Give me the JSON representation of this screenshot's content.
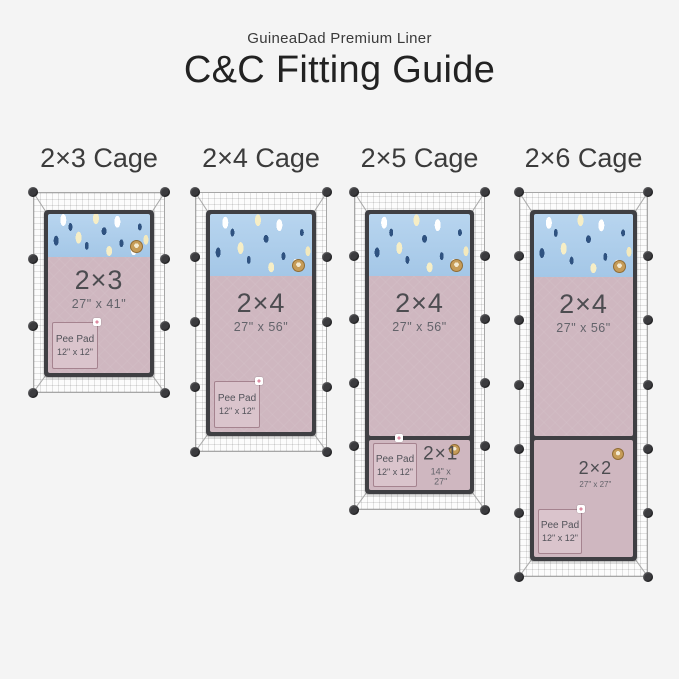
{
  "header": {
    "brand": "GuineaDad Premium Liner",
    "title": "C&C Fitting Guide"
  },
  "cages": [
    {
      "title": "2×3 Cage",
      "main_liner": {
        "name": "2×3",
        "dims": "27\" x 41\""
      },
      "pee_pad": {
        "name": "Pee Pad",
        "dims": "12\" x 12\""
      }
    },
    {
      "title": "2×4 Cage",
      "main_liner": {
        "name": "2×4",
        "dims": "27\" x 56\""
      },
      "pee_pad": {
        "name": "Pee Pad",
        "dims": "12\" x 12\""
      }
    },
    {
      "title": "2×5 Cage",
      "main_liner": {
        "name": "2×4",
        "dims": "27\" x 56\""
      },
      "sub_liner": {
        "name": "2×1",
        "dims": "14\" x 27\""
      },
      "pee_pad": {
        "name": "Pee Pad",
        "dims": "12\" x 12\""
      }
    },
    {
      "title": "2×6 Cage",
      "main_liner": {
        "name": "2×4",
        "dims": "27\" x 56\""
      },
      "sub_liner": {
        "name": "2×2",
        "dims": "27\" x 27\""
      },
      "pee_pad": {
        "name": "Pee Pad",
        "dims": "12\" x 12\""
      }
    }
  ],
  "icons": {
    "logo_badge": "guineadad-face-badge",
    "connector": "cage-connector-dot",
    "snap": "liner-snap-button"
  },
  "colors": {
    "background": "#f4f4f4",
    "liner_pink": "#cfb7c0",
    "pee_pad_pink": "#dac4cc",
    "fleece_blue": "#a9cdec",
    "confetti_navy": "#2f5280",
    "confetti_cream": "#f6eec6",
    "frame_dark": "#3f3f43",
    "badge_gold": "#c69c58",
    "text_dark": "#3a3a3a"
  }
}
